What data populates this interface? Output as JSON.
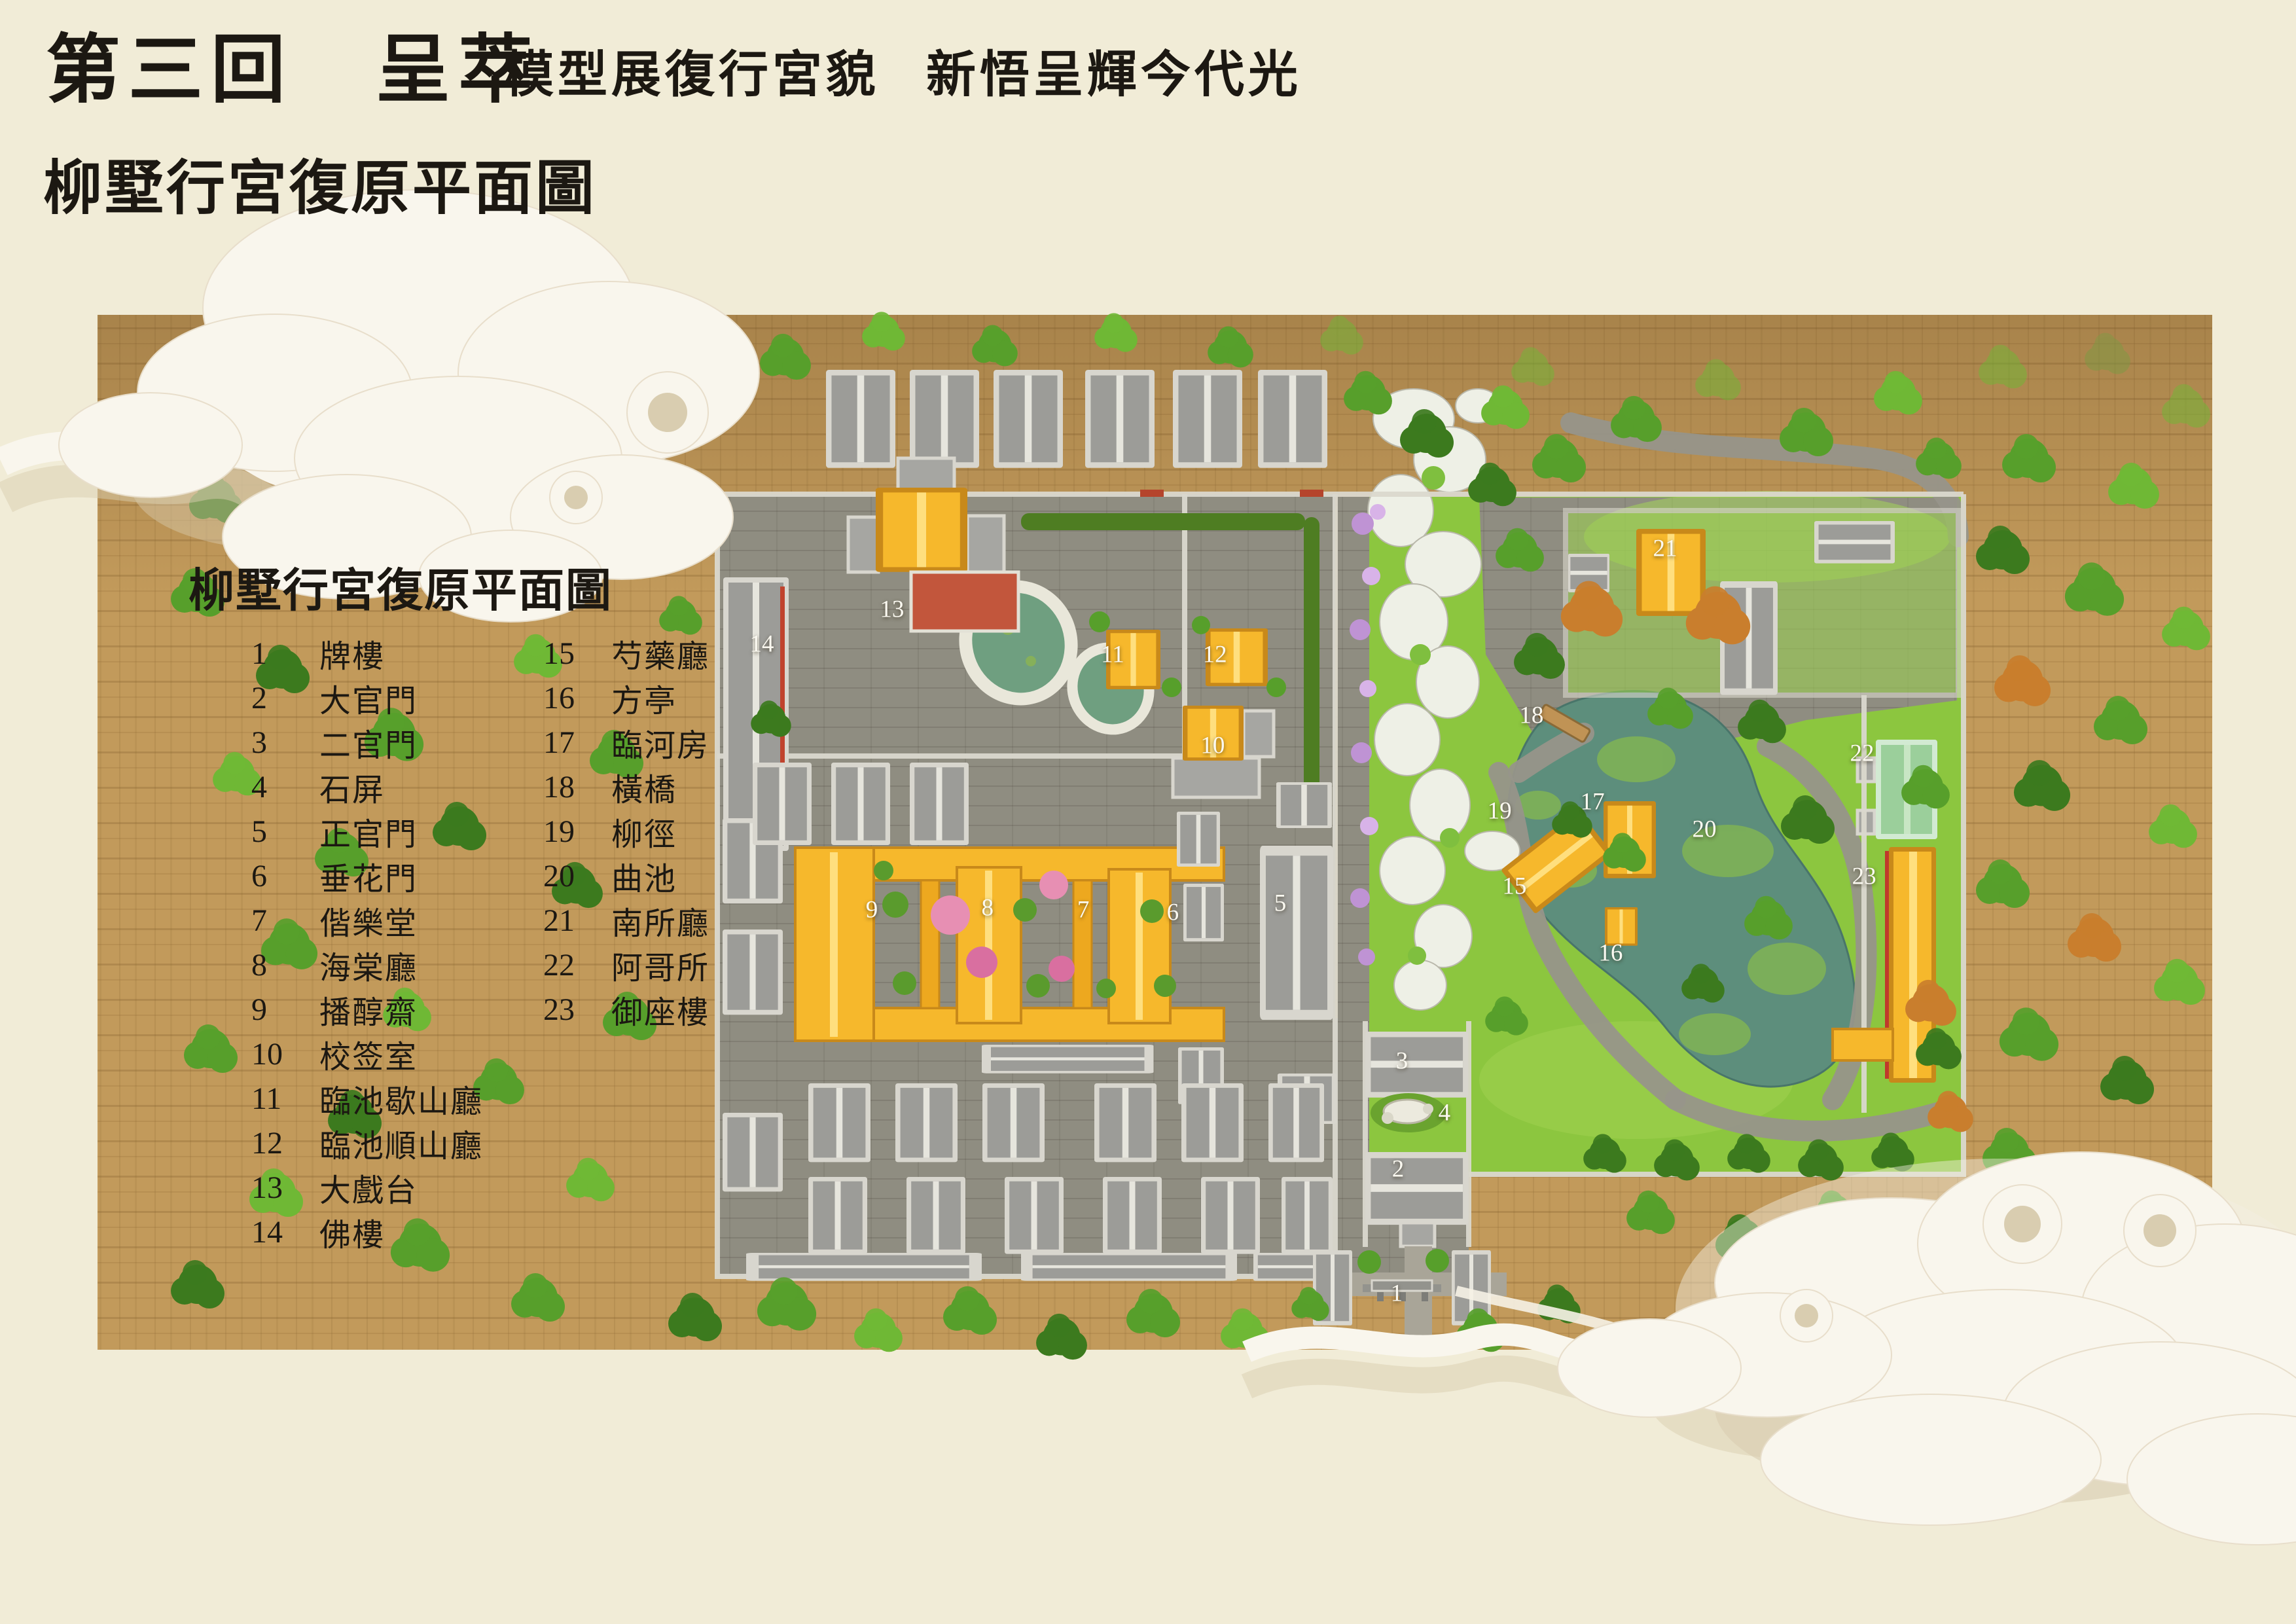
{
  "header": {
    "chapter_title": "第三回　呈萃",
    "subtitle_left": "模型展復行宮貌",
    "subtitle_right": "新悟呈輝今代光",
    "page_caption": "柳墅行宮復原平面圖"
  },
  "map": {
    "type": "site_plan",
    "legend_title": "柳墅行宮復原平面圖",
    "labels": [
      {
        "num": "1",
        "x": 60.83,
        "y": 79.65
      },
      {
        "num": "2",
        "x": 60.89,
        "y": 71.99
      },
      {
        "num": "3",
        "x": 61.06,
        "y": 65.34
      },
      {
        "num": "4",
        "x": 62.91,
        "y": 68.52
      },
      {
        "num": "5",
        "x": 55.76,
        "y": 55.62
      },
      {
        "num": "6",
        "x": 51.08,
        "y": 56.19
      },
      {
        "num": "7",
        "x": 47.18,
        "y": 56.03
      },
      {
        "num": "8",
        "x": 43.01,
        "y": 55.91
      },
      {
        "num": "9",
        "x": 37.97,
        "y": 56.03
      },
      {
        "num": "10",
        "x": 52.82,
        "y": 45.91
      },
      {
        "num": "11",
        "x": 48.46,
        "y": 40.31
      },
      {
        "num": "12",
        "x": 52.91,
        "y": 40.31
      },
      {
        "num": "13",
        "x": 38.85,
        "y": 37.52
      },
      {
        "num": "14",
        "x": 33.18,
        "y": 39.66
      },
      {
        "num": "15",
        "x": 65.96,
        "y": 54.57
      },
      {
        "num": "16",
        "x": 70.15,
        "y": 58.69
      },
      {
        "num": "17",
        "x": 69.36,
        "y": 49.38
      },
      {
        "num": "18",
        "x": 66.7,
        "y": 44.05
      },
      {
        "num": "19",
        "x": 65.31,
        "y": 49.94
      },
      {
        "num": "20",
        "x": 74.23,
        "y": 51.07
      },
      {
        "num": "21",
        "x": 72.52,
        "y": 33.78
      },
      {
        "num": "22",
        "x": 81.1,
        "y": 46.39
      },
      {
        "num": "23",
        "x": 81.19,
        "y": 53.97
      }
    ]
  },
  "legend": {
    "column1": [
      {
        "num": "1",
        "name": "牌樓"
      },
      {
        "num": "2",
        "name": "大官門"
      },
      {
        "num": "3",
        "name": "二官門"
      },
      {
        "num": "4",
        "name": "石屏"
      },
      {
        "num": "5",
        "name": "正官門"
      },
      {
        "num": "6",
        "name": "垂花門"
      },
      {
        "num": "7",
        "name": "偕樂堂"
      },
      {
        "num": "8",
        "name": "海棠廳"
      },
      {
        "num": "9",
        "name": "播醇齋"
      },
      {
        "num": "10",
        "name": "校签室"
      },
      {
        "num": "11",
        "name": "臨池歇山廳"
      },
      {
        "num": "12",
        "name": "臨池順山廳"
      },
      {
        "num": "13",
        "name": "大戲台"
      },
      {
        "num": "14",
        "name": "佛樓"
      }
    ],
    "column2": [
      {
        "num": "15",
        "name": "芍藥廳"
      },
      {
        "num": "16",
        "name": "方亭"
      },
      {
        "num": "17",
        "name": "臨河房"
      },
      {
        "num": "18",
        "name": "橫橋"
      },
      {
        "num": "19",
        "name": "柳徑"
      },
      {
        "num": "20",
        "name": "曲池"
      },
      {
        "num": "21",
        "name": "南所廳"
      },
      {
        "num": "22",
        "name": "阿哥所"
      },
      {
        "num": "23",
        "name": "御座樓"
      }
    ]
  },
  "colors": {
    "paper": "#f1ecd7",
    "ground": "#c29a5b",
    "paving": "#8f8d81",
    "grass": "#8cc63f",
    "water": "#5d8e7c",
    "roof_gray": "#9c9c98",
    "roof_gold": "#f6b82c",
    "roof_green": "#9bcf9b",
    "terrace_red": "#c2563c",
    "label_text": "#fbf9f1",
    "ink": "#1c1812"
  }
}
